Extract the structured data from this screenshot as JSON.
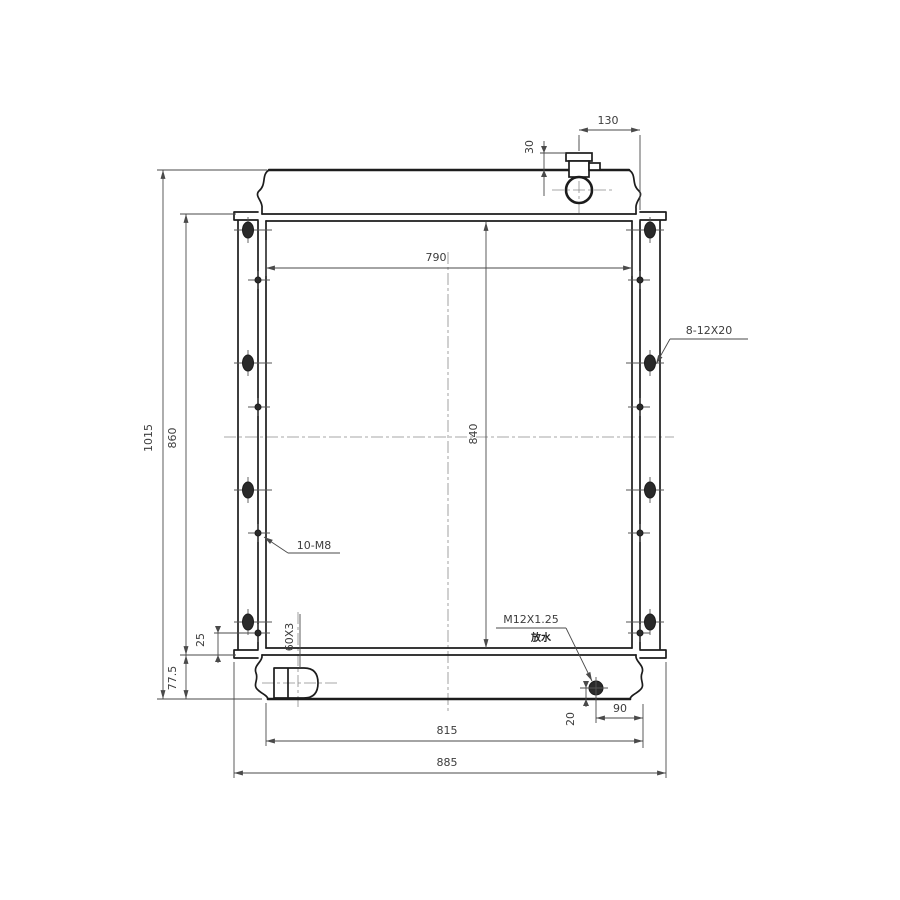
{
  "drawing": {
    "type": "technical-drawing",
    "subject": "radiator assembly front view",
    "colors": {
      "outline": "#1c1c1c",
      "dimension": "#4a4a4a",
      "background": "#ffffff"
    },
    "dims": {
      "top_neck_offset": "130",
      "neck_height": "30",
      "core_width": "790",
      "core_height": "840",
      "overall_height": "1015",
      "bracket_height": "860",
      "tank_depth": "77.5",
      "screw_edge_offset": "25",
      "drain_height": "20",
      "drain_side_offset": "90",
      "bottom_tank_width": "815",
      "overall_width": "885"
    },
    "callouts": {
      "left_screws": "10-M8",
      "right_slots": "8-12X20",
      "drain_thread": "M12X1.25",
      "drain_note": "放水",
      "outlet_tube": "60X3"
    }
  }
}
